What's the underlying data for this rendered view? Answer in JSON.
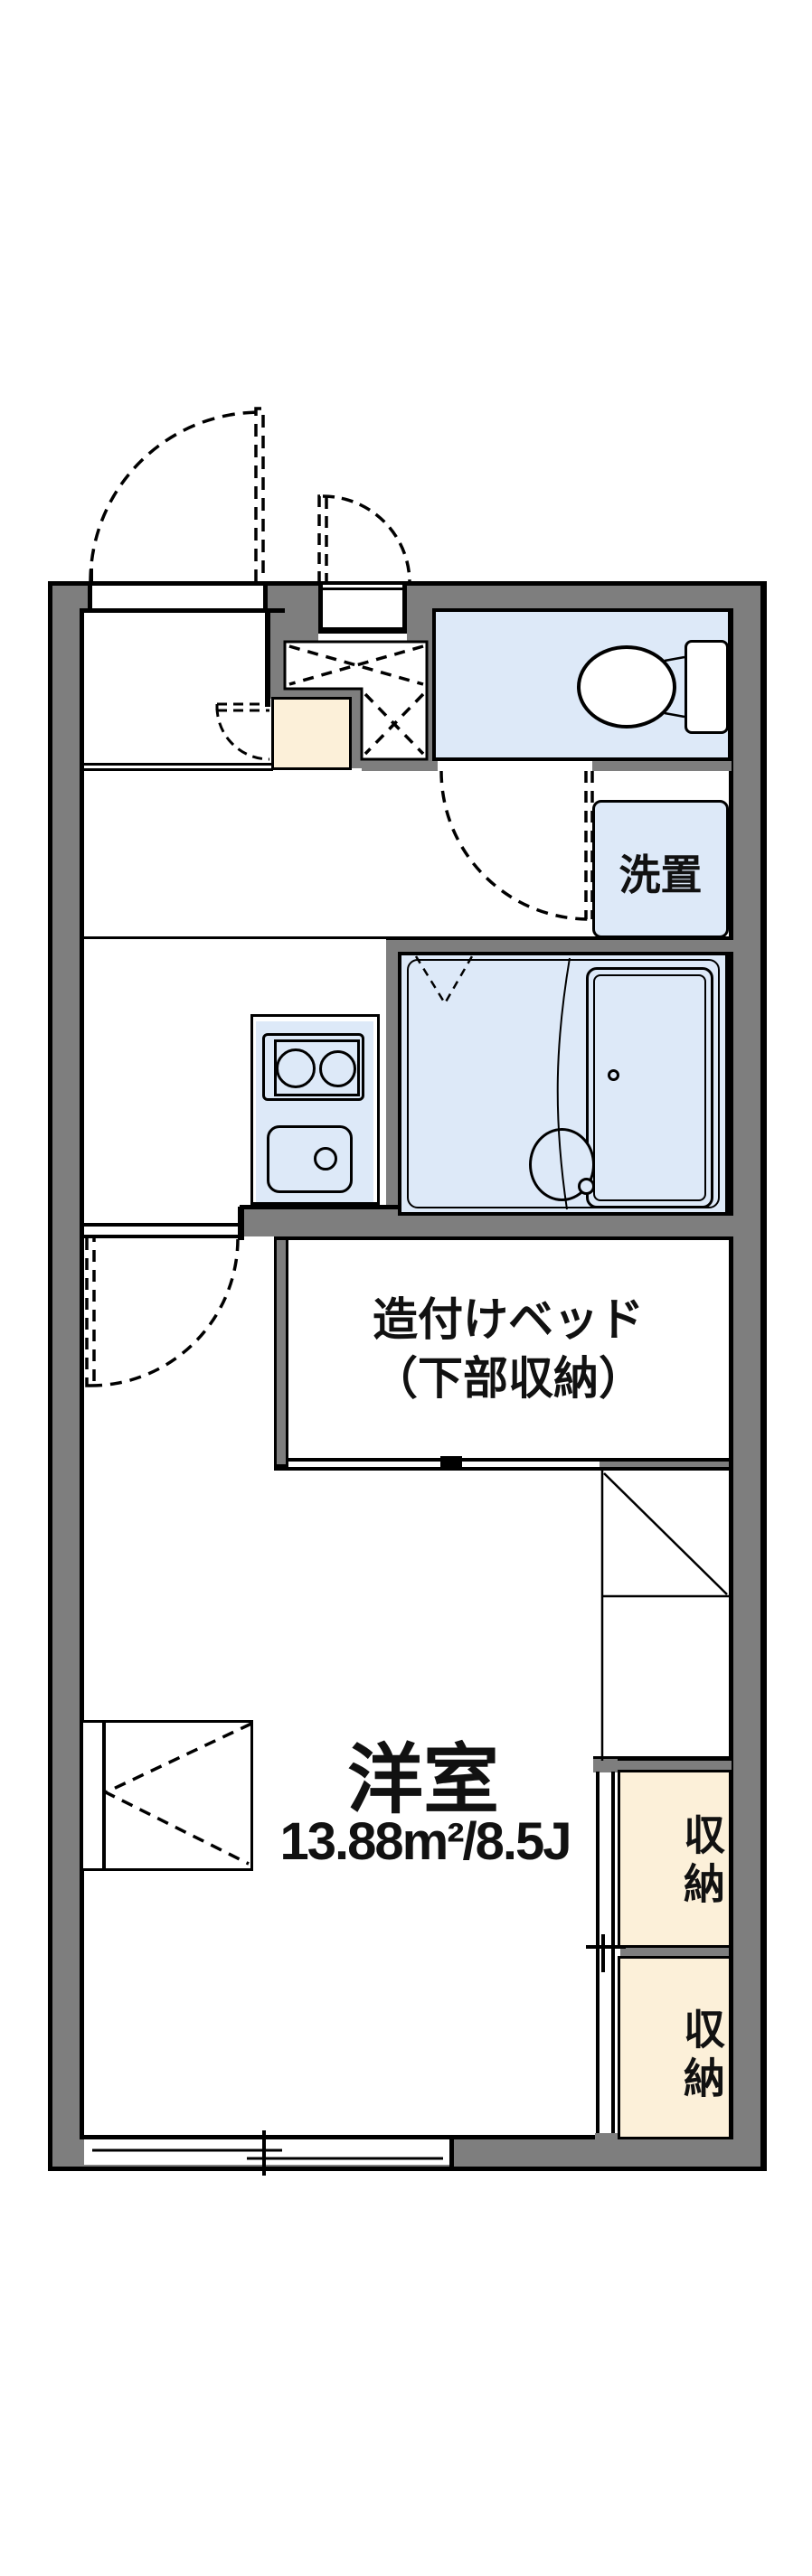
{
  "plan": {
    "type": "apartment-floor-plan",
    "colors": {
      "wall_gray": "#7e7e7e",
      "fixture_blue": "#dde9f8",
      "storage_cream": "#fcf0d9",
      "line_black": "#000000",
      "background": "#ffffff"
    },
    "rooms": {
      "western_room": {
        "name": "洋室",
        "area": "13.88m²/8.5J"
      },
      "built_in_bed": {
        "line1": "造付けベッド",
        "line2": "（下部収納）"
      },
      "storage_upper": {
        "label": "収納"
      },
      "storage_lower": {
        "label": "収納"
      },
      "laundry": {
        "label": "洗置"
      }
    }
  }
}
